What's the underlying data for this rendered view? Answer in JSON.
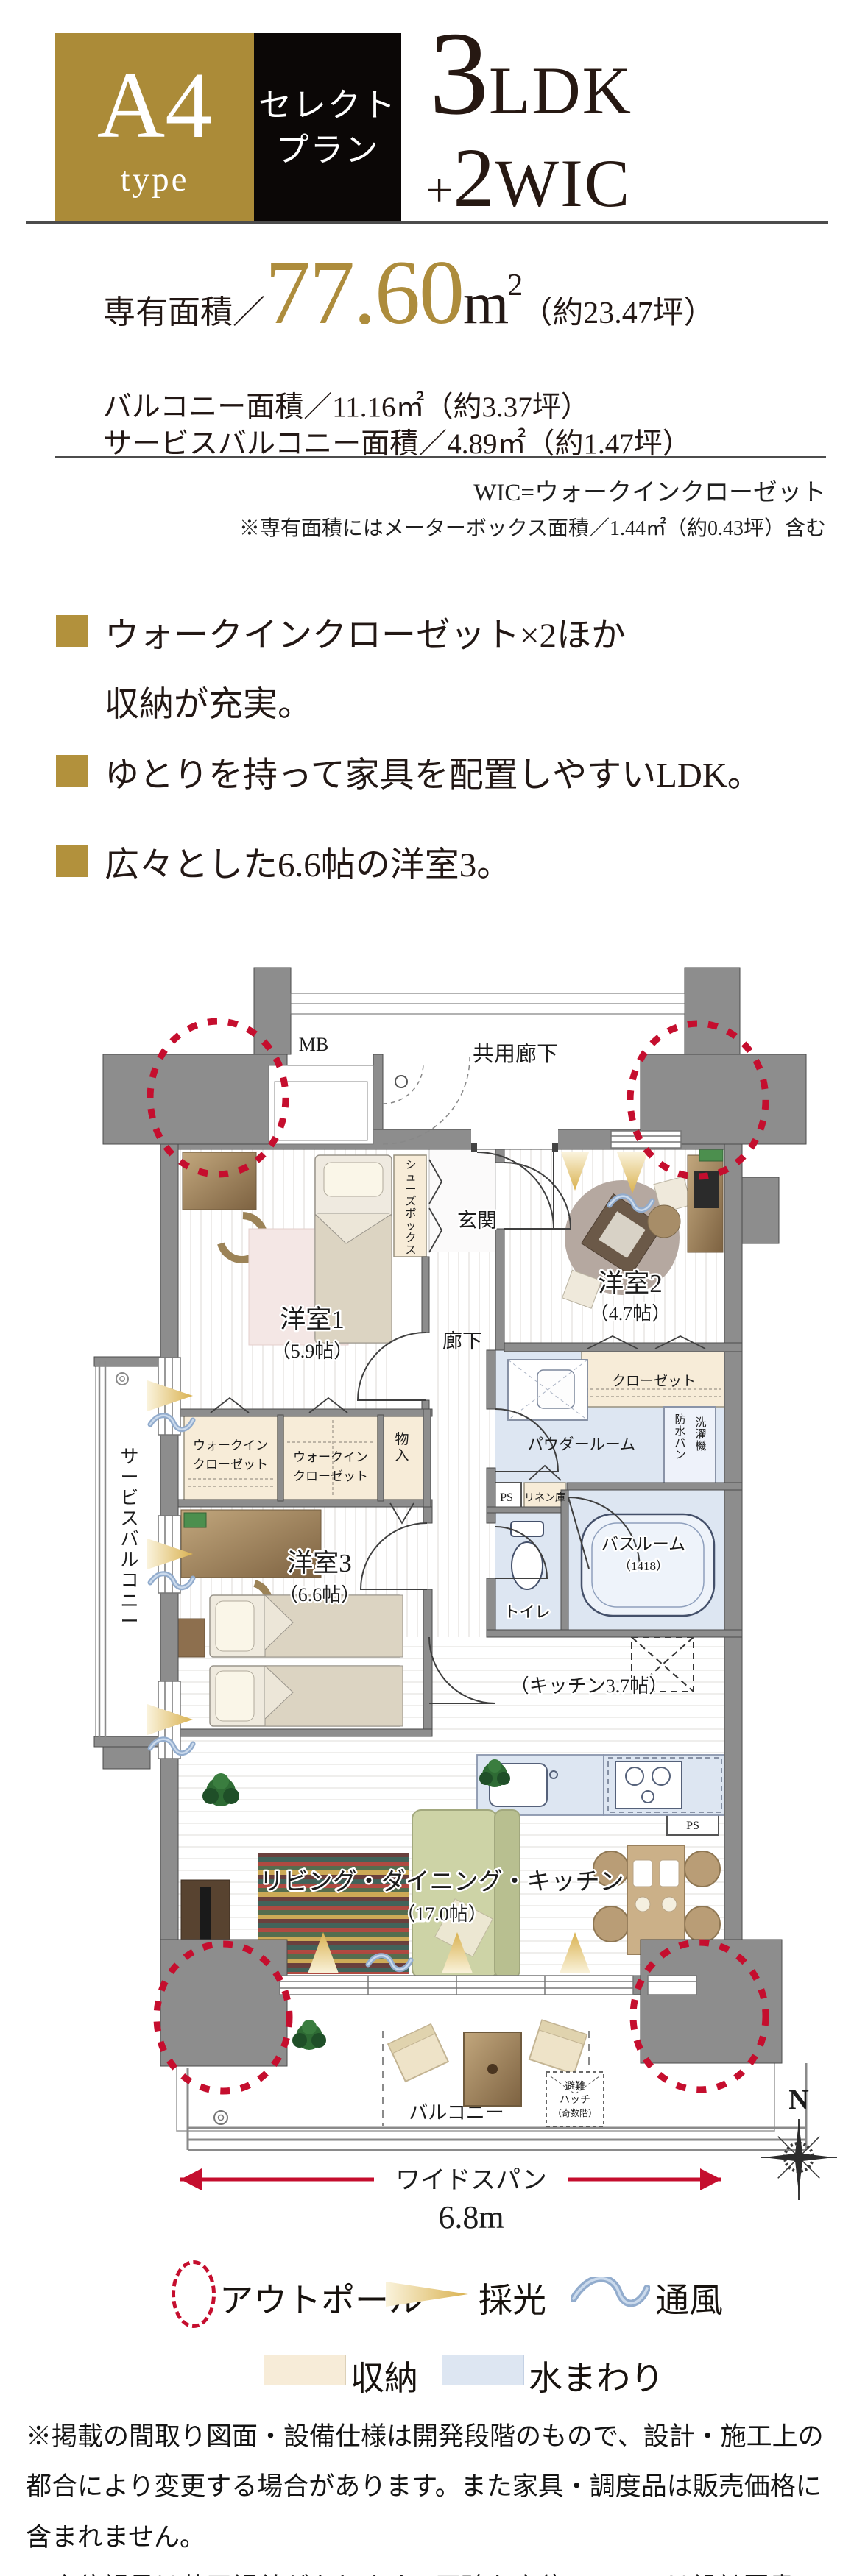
{
  "header": {
    "type_label": "A4",
    "type_suffix": "type",
    "badge_line1": "セレクト",
    "badge_line2": "プラン",
    "layout_number": "3",
    "layout_unit": "LDK",
    "layout_plus": "+",
    "layout_wic_count": "2",
    "layout_wic": "WIC"
  },
  "areas": {
    "main_label": "専有面積／",
    "main_value": "77.60",
    "main_unit": "m",
    "main_unit_sup": "2",
    "main_tsubo": "（約23.47坪）",
    "balcony": "バルコニー面積／11.16㎡（約3.37坪）",
    "service_balcony": "サービスバルコニー面積／4.89㎡（約1.47坪）"
  },
  "notes": {
    "wic": "WIC=ウォークインクローゼット",
    "meter_box": "※専有面積にはメーターボックス面積／1.44㎡（約0.43坪）含む"
  },
  "features": [
    {
      "line1": "ウォークインクローゼット×2ほか",
      "line2": "収納が充実。"
    },
    {
      "line1": "ゆとりを持って家具を配置しやすいLDK。"
    },
    {
      "line1": "広々とした6.6帖の洋室3。"
    }
  ],
  "floorplan": {
    "common_corridor": "共用廊下",
    "mb": "MB",
    "entrance": "玄関",
    "shoes_box": "シューズボックス",
    "corridor": "廊下",
    "room1": "洋室1",
    "room1_size": "（5.9帖）",
    "room2": "洋室2",
    "room2_size": "（4.7帖）",
    "room3": "洋室3",
    "room3_size": "（6.6帖）",
    "wic_line1": "ウォークイン",
    "wic_line2": "クローゼット",
    "storage_small": "物入",
    "closet": "クローゼット",
    "powder_room": "パウダールーム",
    "laundry_col1": "洗濯機",
    "laundry_col2": "防水パン",
    "linen": "リネン庫",
    "ps": "PS",
    "bathroom": "バスルーム",
    "bathroom_size": "（1418）",
    "toilet": "トイレ",
    "kitchen": "（キッチン3.7帖）",
    "ldk": "リビング・ダイニング・キッチン",
    "ldk_size": "（17.0帖）",
    "balcony": "バルコニー",
    "service_balcony": "サービスバルコニー",
    "hatch_line1": "避難",
    "hatch_line2": "ハッチ",
    "hatch_line3": "（奇数階）",
    "wide_span": "ワイドスパン",
    "wide_span_value": "6.8m",
    "compass_n": "N"
  },
  "legend": {
    "outpole": "アウトポール",
    "light": "採光",
    "ventilation": "通風",
    "storage": "収納",
    "water": "水まわり"
  },
  "footer": {
    "disclaimer1": "※掲載の間取り図面・設備仕様は開発段階のもので、設計・施工上の都合により変更する場合があります。また家具・調度品は販売価格に含まれません。",
    "disclaimer2": "※方位記号は若干誤差があります。正確な方位については設計図書でご確認ください。"
  },
  "colors": {
    "gold": "#ab8b38",
    "gold_text": "#ad8c3c",
    "black": "#0b0706",
    "text_dark": "#231815",
    "accent_red": "#c50e2e",
    "wall_gray": "#8d8d8d",
    "storage_beige": "#f7ecd8",
    "water_blue": "#dde6f2"
  }
}
